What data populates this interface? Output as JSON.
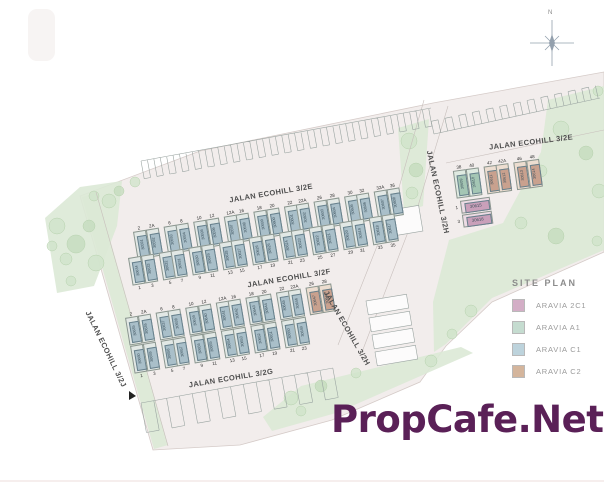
{
  "watermark": {
    "text": "PropCafe.Net",
    "color": "#5a2057"
  },
  "north": {
    "label": "N"
  },
  "legend": {
    "title": "SITE PLAN",
    "items": [
      {
        "label": "ARAVIA 2C1",
        "color": "#d3aec6"
      },
      {
        "label": "ARAVIA A1",
        "color": "#c5dcd0"
      },
      {
        "label": "ARAVIA C1",
        "color": "#bdd3dc"
      },
      {
        "label": "ARAVIA C2",
        "color": "#d4b59c"
      }
    ]
  },
  "colors": {
    "A1": {
      "outer": "#dfeae1",
      "inner": "#a4c6b4"
    },
    "C1": {
      "outer": "#e2e8e5",
      "inner": "#a9bfc9"
    },
    "C2": {
      "outer": "#ecddd0",
      "inner": "#c9a18e"
    },
    "2C1": {
      "outer": "#ecdbe4",
      "inner": "#c9a0ba"
    }
  },
  "street_labels": [
    {
      "id": "ecohill-3-2e-left",
      "text": "JALAN ECOHILL 3/2E"
    },
    {
      "id": "ecohill-3-2e-right",
      "text": "JALAN ECOHILL 3/2E"
    },
    {
      "id": "ecohill-3-2f",
      "text": "JALAN ECOHILL 3/2F"
    },
    {
      "id": "ecohill-3-2g",
      "text": "JALAN ECOHILL 3/2G"
    },
    {
      "id": "ecohill-3-2h-upper",
      "text": "JALAN ECOHILL 3/2H"
    },
    {
      "id": "ecohill-3-2h-lower",
      "text": "JALAN ECOHILL 3/2H"
    },
    {
      "id": "ecohill-3-2j",
      "text": "JALAN ECOHILL 3/2J"
    }
  ],
  "rows": [
    {
      "name": "row-3-2e-south",
      "default_type": "C1",
      "lots": [
        {
          "unit": "2",
          "lot": "30591"
        },
        {
          "unit": "2A",
          "lot": "30592"
        },
        {
          "unit": "6",
          "lot": "30593"
        },
        {
          "unit": "8",
          "lot": "30594"
        },
        {
          "unit": "10",
          "lot": "30595"
        },
        {
          "unit": "12",
          "lot": "30596"
        },
        {
          "unit": "12A",
          "lot": "30597"
        },
        {
          "unit": "16",
          "lot": "30598"
        },
        {
          "unit": "18",
          "lot": "30599"
        },
        {
          "unit": "20",
          "lot": "30600"
        },
        {
          "unit": "22",
          "lot": "30601"
        },
        {
          "unit": "22A",
          "lot": "30602"
        },
        {
          "unit": "26",
          "lot": "30603"
        },
        {
          "unit": "28",
          "lot": "30604"
        },
        {
          "unit": "30",
          "lot": "30605"
        },
        {
          "unit": "32",
          "lot": "30606"
        },
        {
          "unit": "32A",
          "lot": "30607"
        },
        {
          "unit": "36",
          "lot": "30608"
        }
      ]
    },
    {
      "name": "row-3-2f-north",
      "default_type": "C1",
      "lots": [
        {
          "unit": "1",
          "lot": "30634"
        },
        {
          "unit": "3",
          "lot": "30633"
        },
        {
          "unit": "5",
          "lot": "30632"
        },
        {
          "unit": "7",
          "lot": "30631"
        },
        {
          "unit": "9",
          "lot": "30630"
        },
        {
          "unit": "11",
          "lot": "30629"
        },
        {
          "unit": "13",
          "lot": "30628"
        },
        {
          "unit": "15",
          "lot": "30627"
        },
        {
          "unit": "17",
          "lot": "30626"
        },
        {
          "unit": "19",
          "lot": "30625"
        },
        {
          "unit": "21",
          "lot": "30624"
        },
        {
          "unit": "23",
          "lot": "30623"
        },
        {
          "unit": "25",
          "lot": "30622"
        },
        {
          "unit": "27",
          "lot": "30621"
        },
        {
          "unit": "29",
          "lot": "30620"
        },
        {
          "unit": "31",
          "lot": "30619"
        },
        {
          "unit": "33",
          "lot": "30618"
        },
        {
          "unit": "35",
          "lot": "30617"
        }
      ]
    },
    {
      "name": "row-3-2f-south",
      "default_type": "C1",
      "lots": [
        {
          "unit": "2",
          "lot": "30635"
        },
        {
          "unit": "2A",
          "lot": "30636"
        },
        {
          "unit": "6",
          "lot": "30637"
        },
        {
          "unit": "8",
          "lot": "30638"
        },
        {
          "unit": "10",
          "lot": "30639"
        },
        {
          "unit": "12",
          "lot": "30640"
        },
        {
          "unit": "12A",
          "lot": "30641"
        },
        {
          "unit": "16",
          "lot": "30642"
        },
        {
          "unit": "18",
          "lot": "30643"
        },
        {
          "unit": "20",
          "lot": "30644"
        },
        {
          "unit": "22",
          "lot": "30645"
        },
        {
          "unit": "22A",
          "lot": "30646"
        },
        {
          "unit": "26",
          "lot": "30647",
          "type": "C2"
        },
        {
          "unit": "28",
          "lot": "30648",
          "type": "C2"
        }
      ]
    },
    {
      "name": "row-3-2g-north",
      "default_type": "C1",
      "lots": [
        {
          "unit": "1",
          "lot": "30660"
        },
        {
          "unit": "3",
          "lot": "30659"
        },
        {
          "unit": "5",
          "lot": "30658"
        },
        {
          "unit": "7",
          "lot": "30657"
        },
        {
          "unit": "9",
          "lot": "30656"
        },
        {
          "unit": "11",
          "lot": "30655"
        },
        {
          "unit": "13",
          "lot": "30654"
        },
        {
          "unit": "15",
          "lot": "30653"
        },
        {
          "unit": "17",
          "lot": "30652"
        },
        {
          "unit": "19",
          "lot": "30651"
        },
        {
          "unit": "21",
          "lot": "30650"
        },
        {
          "unit": "23",
          "lot": "30649"
        }
      ]
    },
    {
      "name": "row-3-2e-right-cluster",
      "default_type": "A1",
      "lots": [
        {
          "unit": "38",
          "lot": "30609",
          "type": "A1"
        },
        {
          "unit": "40",
          "lot": "30610",
          "type": "A1"
        },
        {
          "unit": "42",
          "lot": "30611",
          "type": "C2"
        },
        {
          "unit": "42A",
          "lot": "30612",
          "type": "C2"
        },
        {
          "unit": "46",
          "lot": "30613",
          "type": "C2"
        },
        {
          "unit": "48",
          "lot": "30614",
          "type": "C2"
        }
      ]
    },
    {
      "name": "cluster-2c1",
      "default_type": "2C1",
      "lots": [
        {
          "unit": "1",
          "lot": "30615"
        },
        {
          "unit": "3",
          "lot": "30616"
        }
      ]
    }
  ]
}
